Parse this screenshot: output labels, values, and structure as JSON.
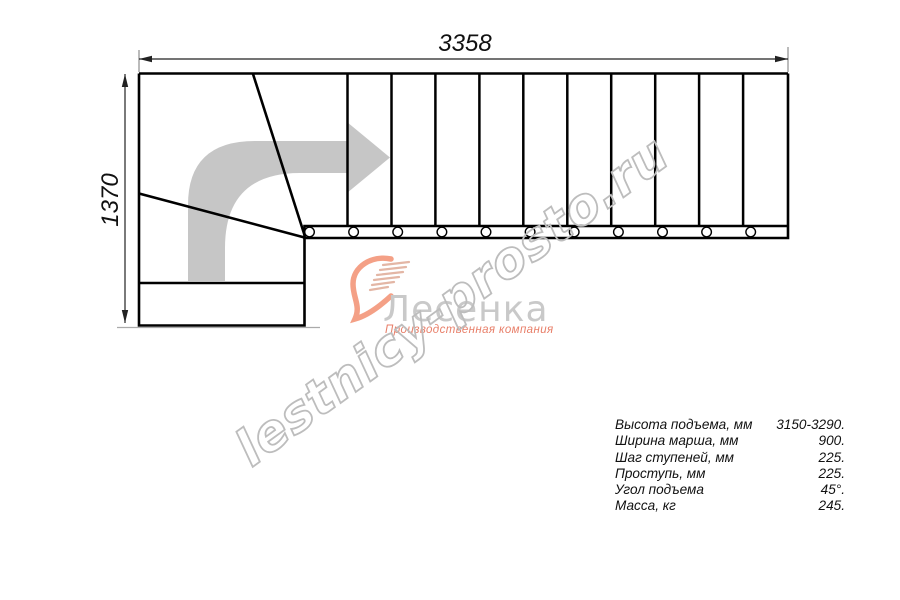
{
  "drawing": {
    "top_dimension": "3358",
    "left_dimension": "1370"
  },
  "watermark": {
    "text": "lestnicy-prosto.ru"
  },
  "logo": {
    "name": "Лесенка",
    "tagline": "Производственная компания"
  },
  "specs": {
    "rows": [
      {
        "label": "Высота подъема, мм",
        "value": "3150-3290."
      },
      {
        "label": "Ширина марша, мм",
        "value": "900."
      },
      {
        "label": "Шаг ступеней, мм",
        "value": "225."
      },
      {
        "label": "Проступь, мм",
        "value": "225."
      },
      {
        "label": "Угол подъема",
        "value": "45°."
      },
      {
        "label": "Масса, кг",
        "value": "245."
      }
    ]
  },
  "colors": {
    "line_black": "#000000",
    "dimension_gray": "#222222",
    "arrow_gray": "#c6c6c6",
    "watermark_gray": "#bdbdbd",
    "logo_gray": "#c9c9c9",
    "logo_salmon": "#ee8168"
  }
}
